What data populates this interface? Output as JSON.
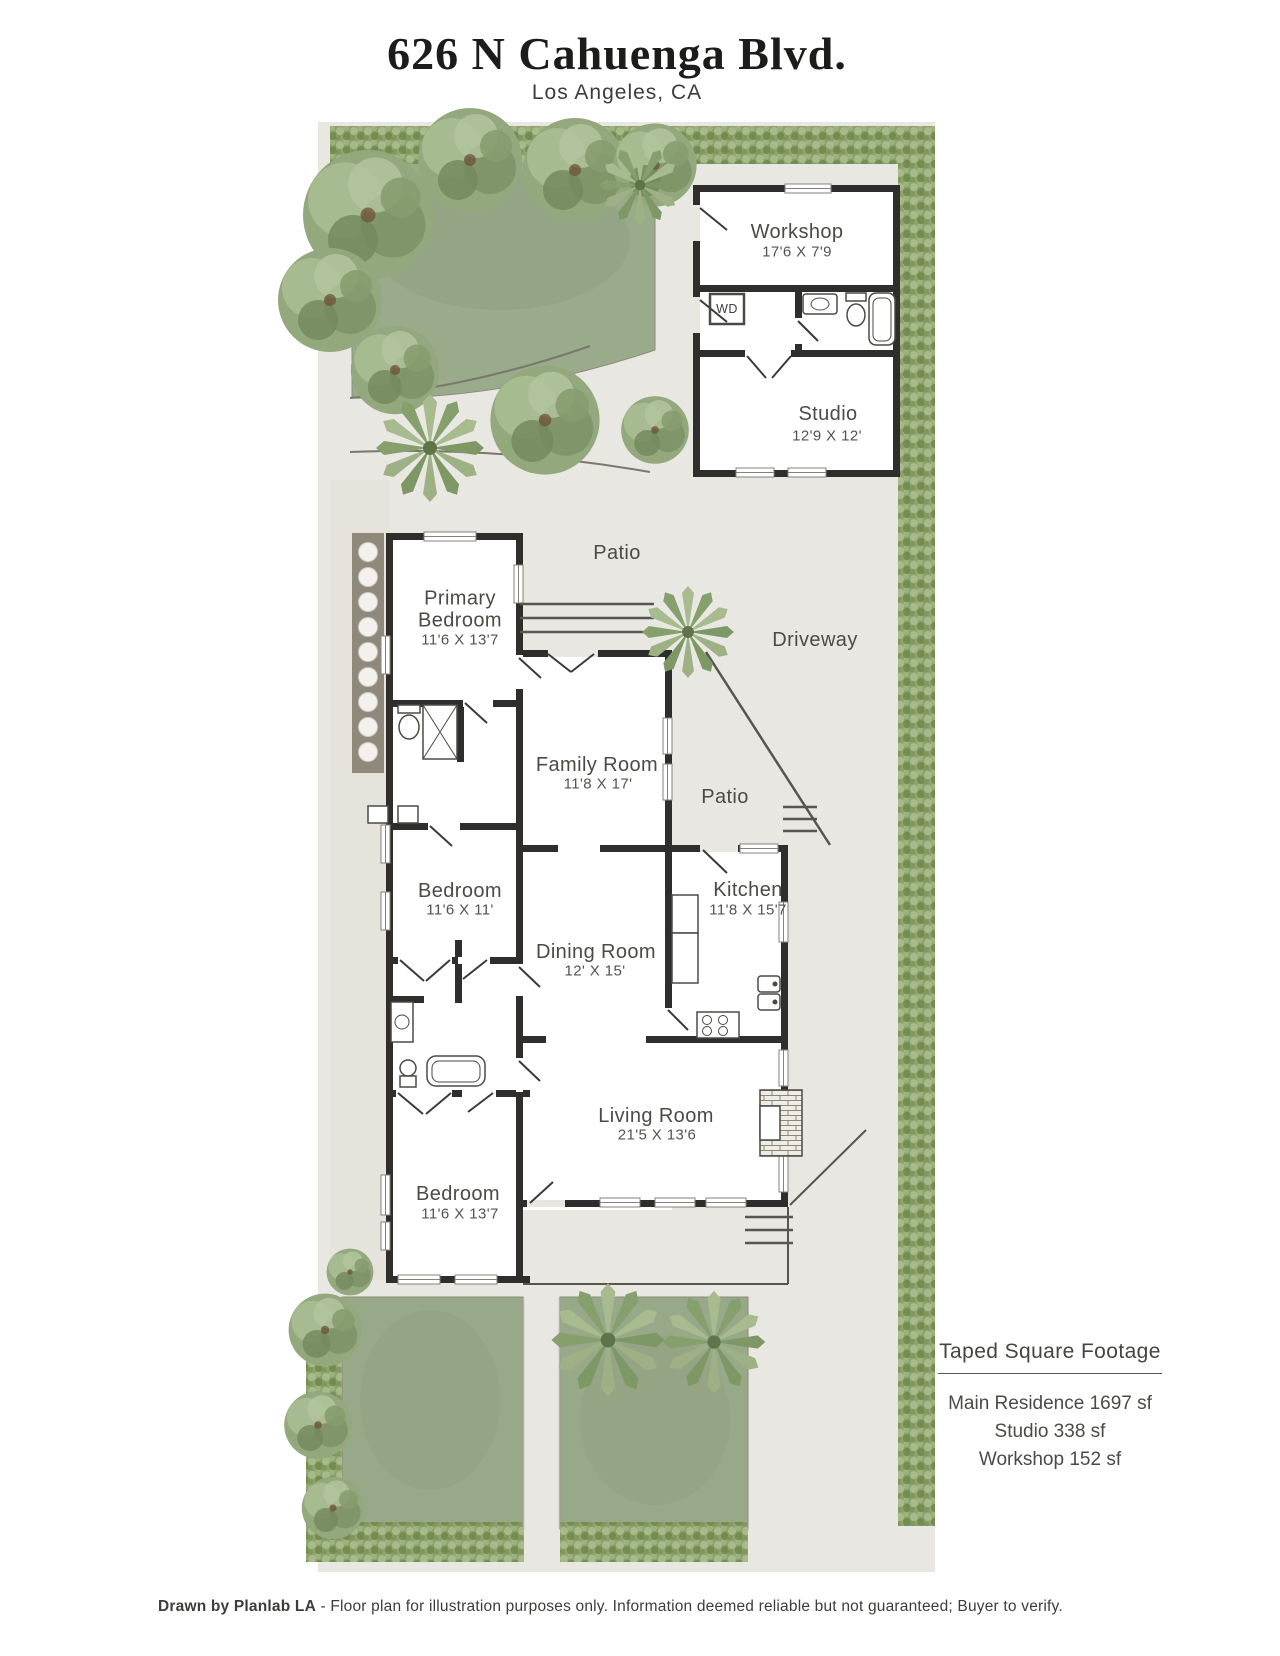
{
  "header": {
    "title": "626 N Cahuenga Blvd.",
    "subtitle": "Los Angeles, CA"
  },
  "plan": {
    "outbuilding": {
      "workshop": {
        "name": "Workshop",
        "dims": "17'6 X 7'9"
      },
      "laundry": {
        "label": "WD"
      },
      "studio": {
        "name": "Studio",
        "dims": "12'9 X 12'"
      }
    },
    "site": {
      "patio_upper": "Patio",
      "driveway": "Driveway",
      "patio_lower": "Patio"
    },
    "rooms": {
      "primary_bedroom": {
        "name": "Primary Bedroom",
        "dims": "11'6 X 13'7"
      },
      "family_room": {
        "name": "Family Room",
        "dims": "11'8 X 17'"
      },
      "bedroom_middle": {
        "name": "Bedroom",
        "dims": "11'6 X 11'"
      },
      "dining_room": {
        "name": "Dining Room",
        "dims": "12' X 15'"
      },
      "kitchen": {
        "name": "Kitchen",
        "dims": "11'8 X 15'7"
      },
      "living_room": {
        "name": "Living Room",
        "dims": "21'5 X 13'6"
      },
      "bedroom_front": {
        "name": "Bedroom",
        "dims": "11'6 X 13'7"
      }
    }
  },
  "footage": {
    "heading": "Taped Square Footage",
    "lines": [
      "Main Residence 1697 sf",
      "Studio 338 sf",
      "Workshop 152 sf"
    ]
  },
  "footer": {
    "credit": "Drawn by Planlab LA",
    "disclaimer": " - Floor plan for illustration purposes only. Information deemed reliable but not guaranteed; Buyer to verify."
  },
  "colors": {
    "wall": "#2f2e2c",
    "pavement": "#e9e7e1",
    "lawn": "#9aab8c",
    "hedge": "#8ea16f",
    "text": "#45453f"
  }
}
